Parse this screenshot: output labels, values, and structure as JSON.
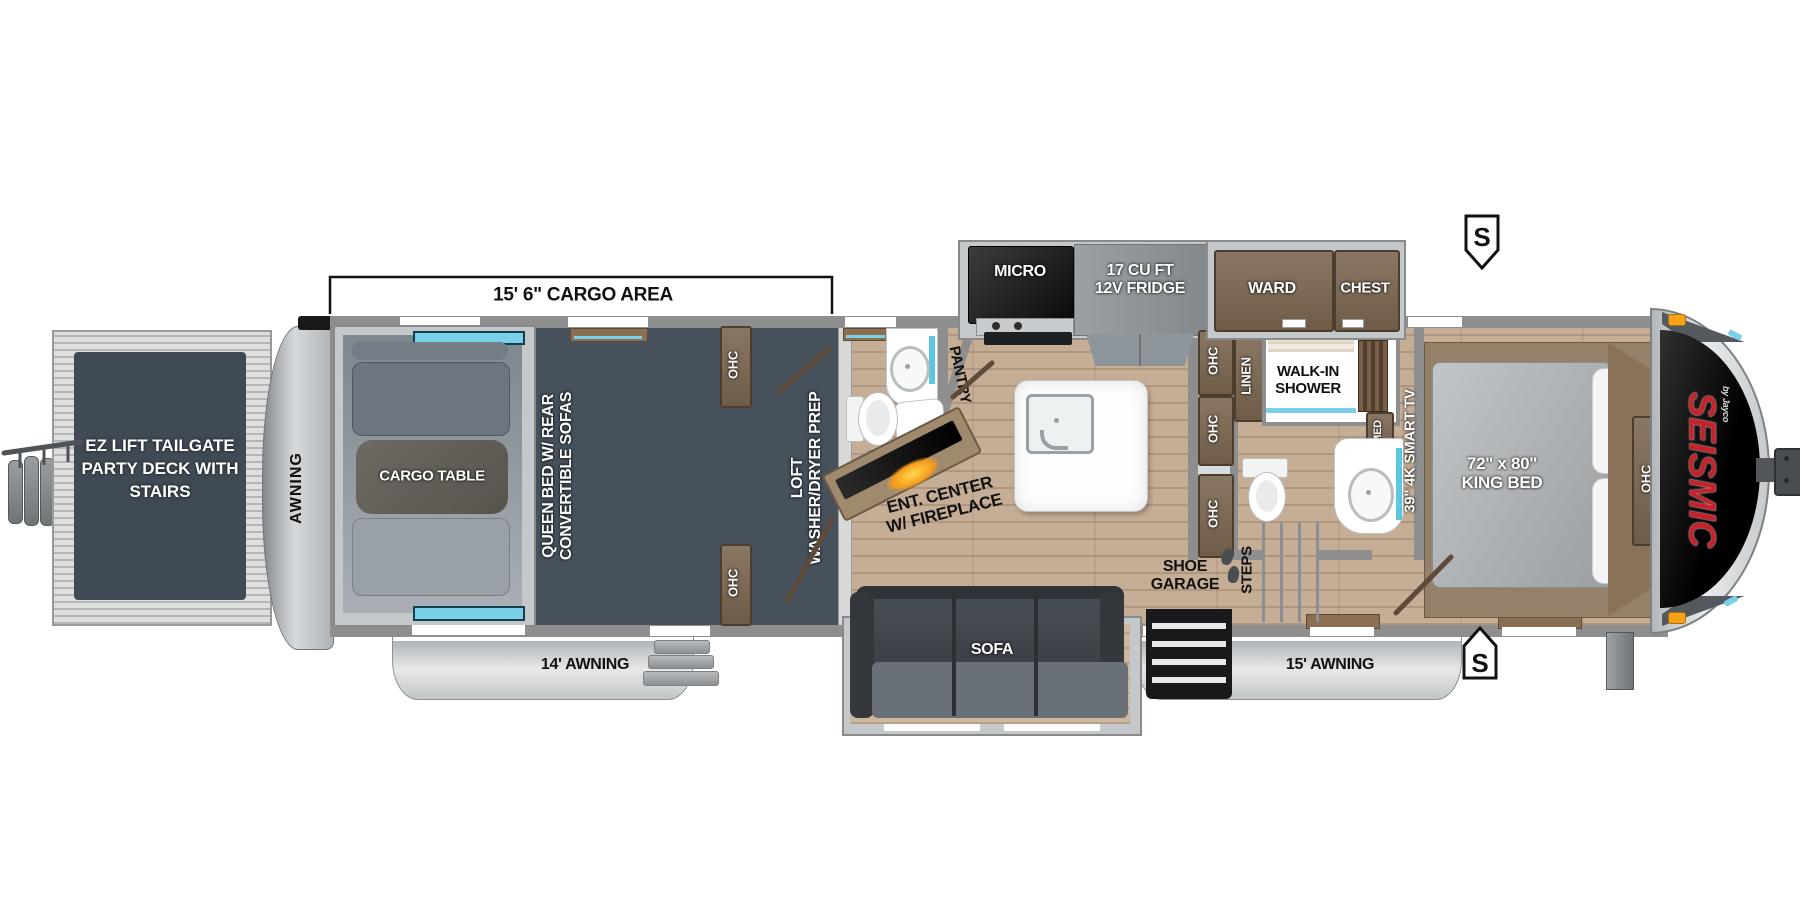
{
  "floorplan": {
    "brand": "SEISMIC",
    "brand_byline": "by Jayco",
    "cargo_area_dimension": "15' 6\" CARGO AREA",
    "speaker_symbol": "S",
    "rear_deck": {
      "line1": "EZ LIFT",
      "line2": "TAILGATE",
      "line3": "PARTY DECK",
      "line4": "WITH STAIRS"
    },
    "rear_awning": "AWNING",
    "awning_left": "14' AWNING",
    "awning_right": "15' AWNING",
    "cargo": {
      "table": "CARGO TABLE",
      "bed_line1": "QUEEN BED W/ REAR",
      "bed_line2": "CONVERTIBLE SOFAS",
      "ohc": "OHC",
      "loft_line1": "LOFT",
      "loft_line2": "WASHER/DRYER PREP"
    },
    "living": {
      "ent_line1": "ENT. CENTER",
      "ent_line2": "W/ FIREPLACE",
      "sofa": "SOFA",
      "pantry": "PANTRY",
      "micro": "MICRO",
      "fridge_line1": "17 CU FT",
      "fridge_line2": "12V FRIDGE",
      "shoe_line1": "SHOE",
      "shoe_line2": "GARAGE",
      "steps": "STEPS"
    },
    "bath": {
      "linen": "LINEN",
      "shower_line1": "WALK-IN",
      "shower_line2": "SHOWER",
      "med": "MED"
    },
    "bedroom": {
      "tv": "39\" 4K SMART TV",
      "ward": "WARD",
      "chest": "CHEST",
      "bed_line1": "72\" x 80\"",
      "bed_line2": "KING BED",
      "ohc": "OHC"
    }
  },
  "colors": {
    "brand_red": "#c4232b",
    "fireplace_glow": "#f5a21b",
    "window_accent": "#7ad0e8",
    "cargo_floor": "#46515c",
    "wood_floor": "#c6ae96",
    "wall_gray": "#8e8e8e",
    "cabinet_brown": "#6e5c49"
  }
}
